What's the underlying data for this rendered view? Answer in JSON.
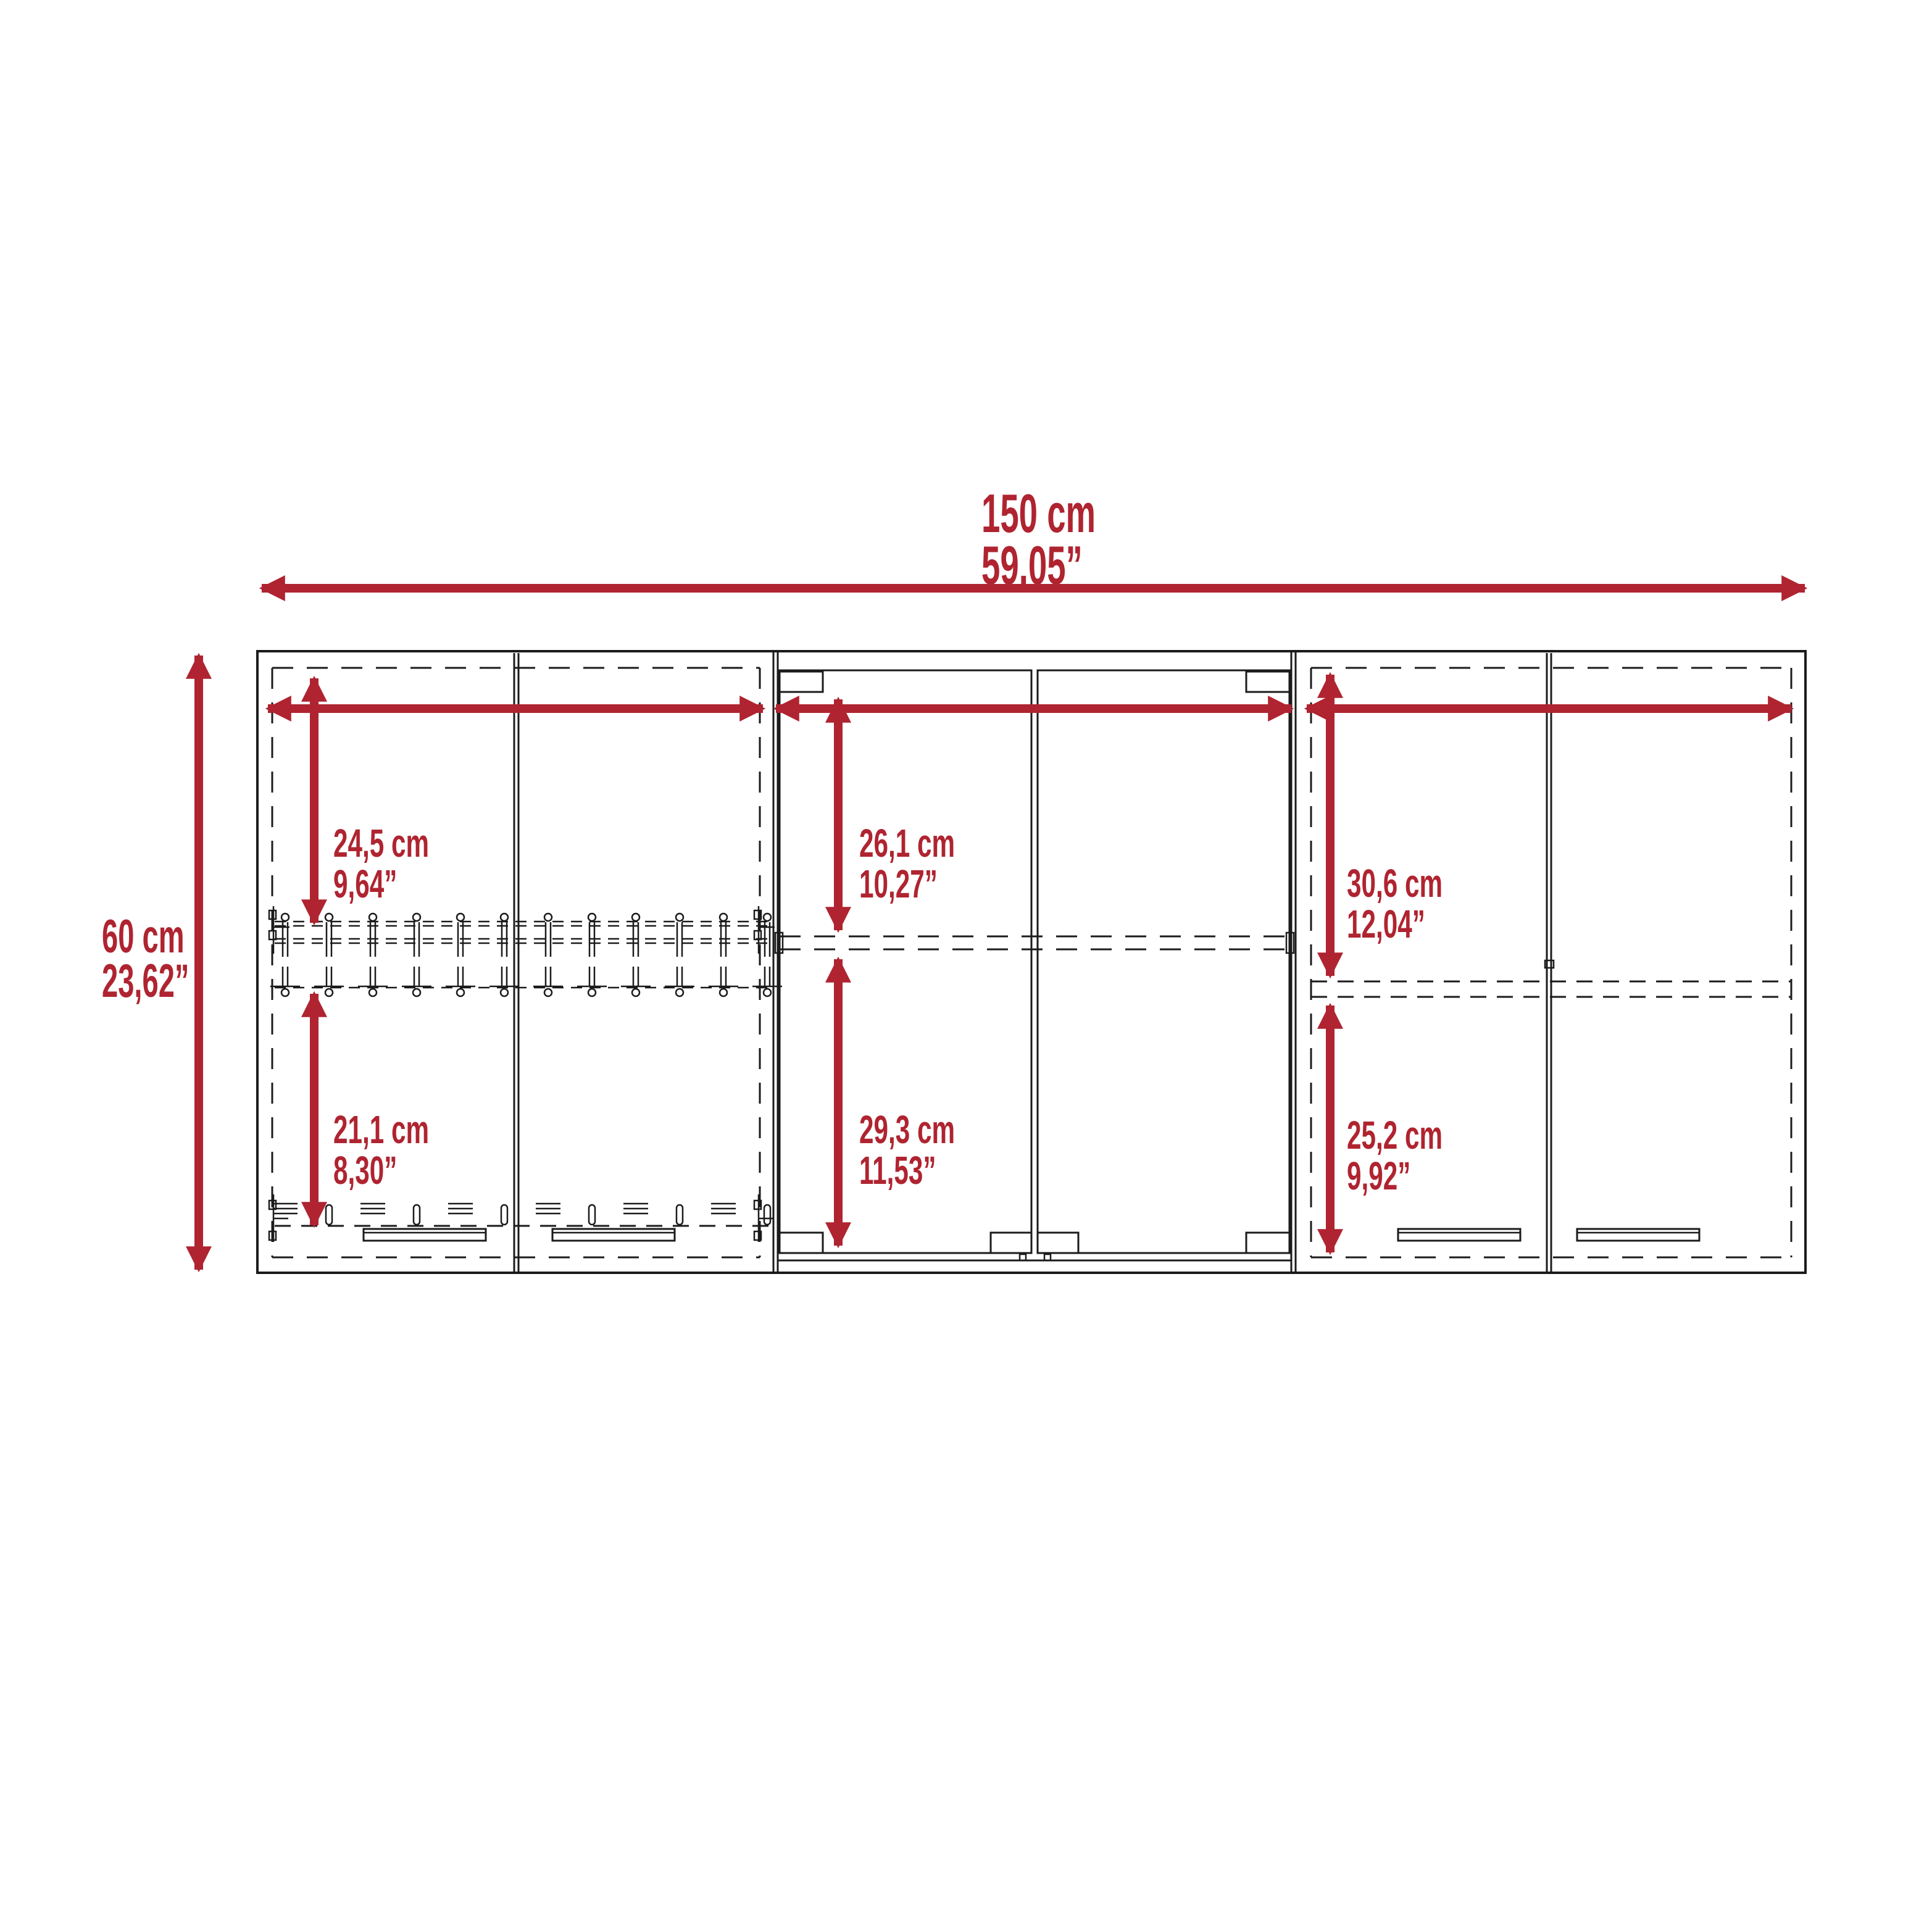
{
  "drawing": {
    "type": "furniture-dimension-diagram",
    "subject": "wall-cabinet-front-elevation",
    "background_color": "#ffffff",
    "line_color": "#1b1b1b",
    "dimension_color": "#af2430"
  },
  "dimensions": {
    "overall_width": {
      "cm": "150 cm",
      "inches": "59,05”"
    },
    "overall_height": {
      "cm": "60 cm",
      "inches": "23,62”"
    },
    "left_upper_opening": {
      "cm": "24,5 cm",
      "inches": "9,64”"
    },
    "left_lower_opening": {
      "cm": "21,1 cm",
      "inches": "8,30”"
    },
    "center_upper_opening": {
      "cm": "26,1 cm",
      "inches": "10,27”"
    },
    "center_lower_opening": {
      "cm": "29,3 cm",
      "inches": "11,53”"
    },
    "right_upper_opening": {
      "cm": "30,6 cm",
      "inches": "12,04”"
    },
    "right_lower_opening": {
      "cm": "25,2 cm",
      "inches": "9,92”"
    }
  }
}
